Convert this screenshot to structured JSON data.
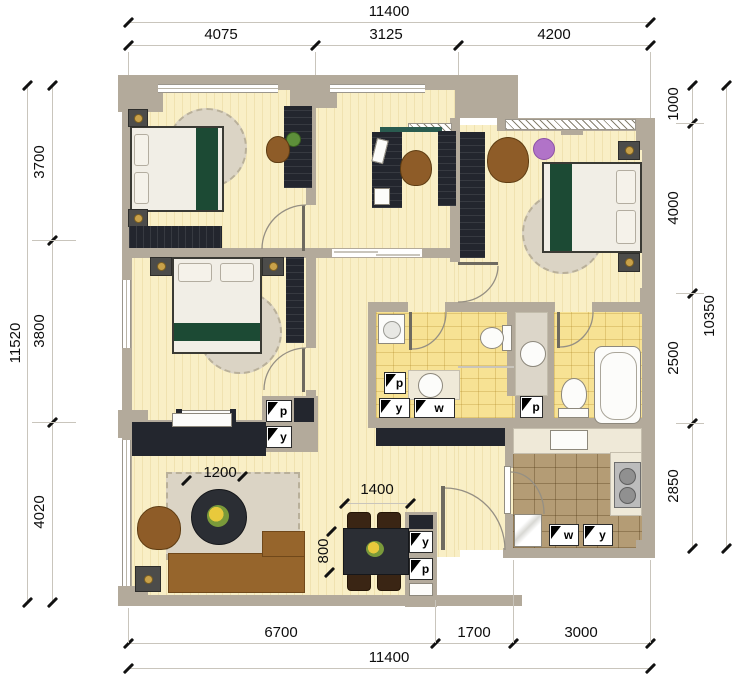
{
  "plan": {
    "type": "apartment-floor-plan"
  },
  "dims": {
    "top": {
      "overall": "11400",
      "segments": [
        "4075",
        "3125",
        "4200"
      ]
    },
    "bottom": {
      "overall": "11400",
      "segments": [
        "6700",
        "1700",
        "3000"
      ]
    },
    "left": {
      "overall": "11520",
      "segments": [
        "3700",
        "3800",
        "4020"
      ]
    },
    "right": {
      "overall": "10350",
      "segments": [
        "1000",
        "4000",
        "2500",
        "2850"
      ]
    },
    "furniture": {
      "coffee_table_diameter": "1200",
      "dining_table_width": "1400",
      "dining_table_depth": "800"
    }
  },
  "fixtures": {
    "living_p": "p",
    "living_y": "y",
    "bath_p": "p",
    "bath_y": "y",
    "bath_w": "w",
    "shaft_p": "p",
    "dining_y": "y",
    "dining_p": "p",
    "kitchen_w": "w",
    "kitchen_y": "y"
  },
  "colors": {
    "floor": "#f9efc6",
    "bath_tile": "#f7e294",
    "kitchen_tile": "#b49c75",
    "wall": "#b3aa9b",
    "furniture_dark": "#23262e",
    "bed_green": "#1c4a34",
    "wood_brown": "#8e5c28",
    "rug": "#dbd4c5",
    "plant_purple": "#b173c8",
    "dim_text": "#111111"
  }
}
